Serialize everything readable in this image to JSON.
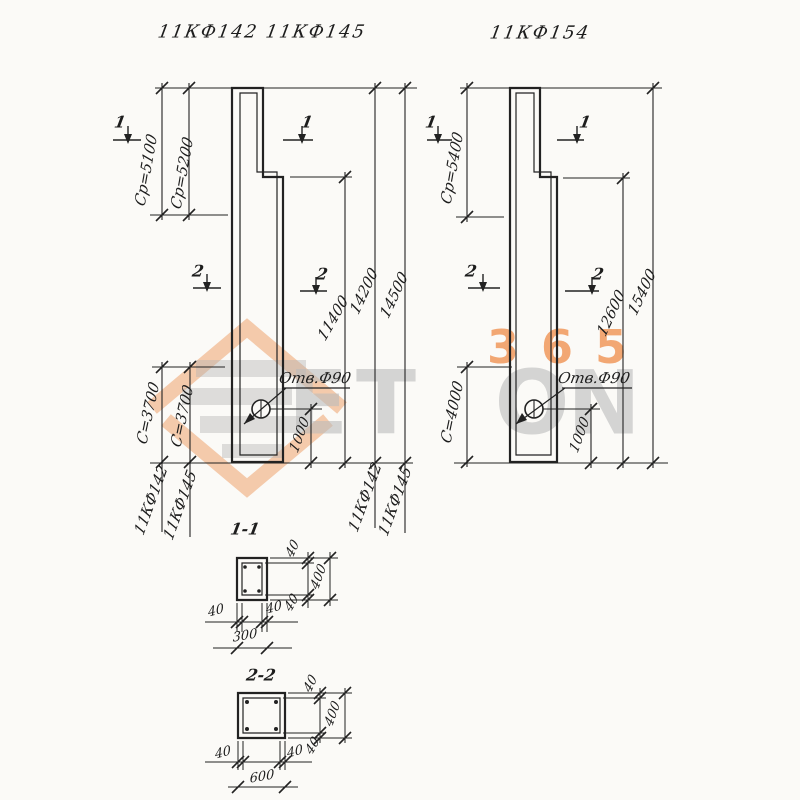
{
  "titles": {
    "left_columns": "11КФ142 11КФ145",
    "right_column": "11КФ154"
  },
  "watermark": {
    "letters": [
      "E",
      "T",
      "O",
      "N"
    ],
    "number": "365",
    "orange": "#f0985c",
    "gray": "#c6c6c6"
  },
  "left_view": {
    "dim_cp_142": "Ср=5100",
    "dim_cp_145": "Ср=5200",
    "dim_step_height": "11400",
    "dim_total_142": "14200",
    "dim_total_145": "14500",
    "dim_c_142": "С=3700",
    "dim_c_145": "С=3700",
    "dim_hole_offset": "1000",
    "hole_label": "Отв.Ф90",
    "mark_142": "11КФ142",
    "mark_145": "11КФ145",
    "section_mark_1": "1",
    "section_mark_2": "2"
  },
  "right_view": {
    "dim_cp": "Ср=5400",
    "dim_step_height": "12600",
    "dim_total": "15400",
    "dim_c": "С=4000",
    "dim_hole_offset": "1000",
    "hole_label": "Отв.Ф90",
    "section_mark_1": "1",
    "section_mark_2": "2"
  },
  "sections": {
    "s11": {
      "title": "1-1",
      "cover": "40",
      "height": "400",
      "width": "300"
    },
    "s22": {
      "title": "2-2",
      "cover": "40",
      "height": "400",
      "width": "600"
    }
  }
}
